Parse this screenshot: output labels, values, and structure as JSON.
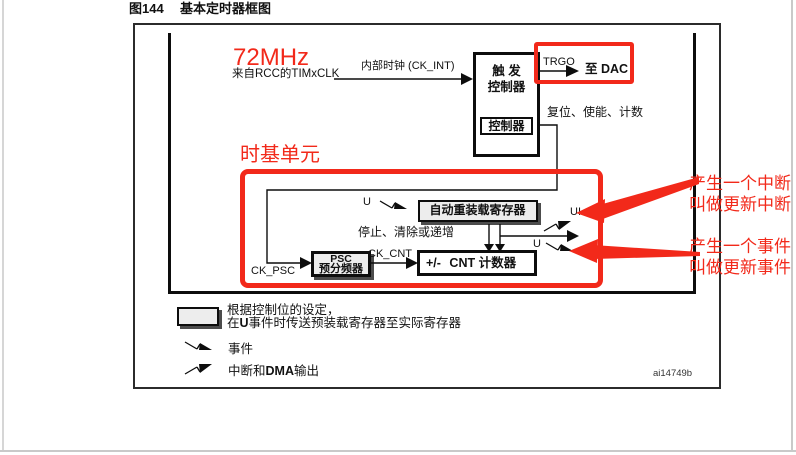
{
  "page": {
    "figure_label": "图144",
    "figure_title": "基本定时器框图",
    "figure_id": "ai14749b"
  },
  "diagram": {
    "clock_freq": "72MHz",
    "clock_source": "来自RCC的TIMxCLK",
    "internal_clock": "内部时钟 (CK_INT)",
    "trigger_controller_line1": "触 发",
    "trigger_controller_line2": "控制器",
    "controller_box": "控制器",
    "trgo": "TRGO",
    "to_dac": "至 DAC",
    "control_signals": "复位、使能、计数",
    "time_base_unit": "时基单元",
    "u_event_top": "U",
    "ui_label": "UI",
    "u_event_bottom": "U",
    "auto_reload_register": "自动重装载寄存器",
    "stop_clear_increment": "停止、清除或递增",
    "psc_line1": "PSC",
    "psc_line2": "预分频器",
    "ck_psc": "CK_PSC",
    "ck_cnt": "CK_CNT",
    "counter_prefix": "+/-",
    "counter_text": "CNT 计数器"
  },
  "annotations": {
    "red_color": "#f2291a",
    "interrupt_note_line1": "产生一个中断",
    "interrupt_note_line2": "叫做更新中断",
    "event_note_line1": "产生一个事件",
    "event_note_line2": "叫做更新事件"
  },
  "legend": {
    "preload_line1": "根据控制位的设定，",
    "preload_line2_pre": "在",
    "preload_line2_bold": "U",
    "preload_line2_post": "事件时传送预装载寄存器至实际寄存器",
    "event_label": "事件",
    "interrupt_label_pre": "中断和",
    "interrupt_label_bold": "DMA",
    "interrupt_label_post": "输出"
  }
}
